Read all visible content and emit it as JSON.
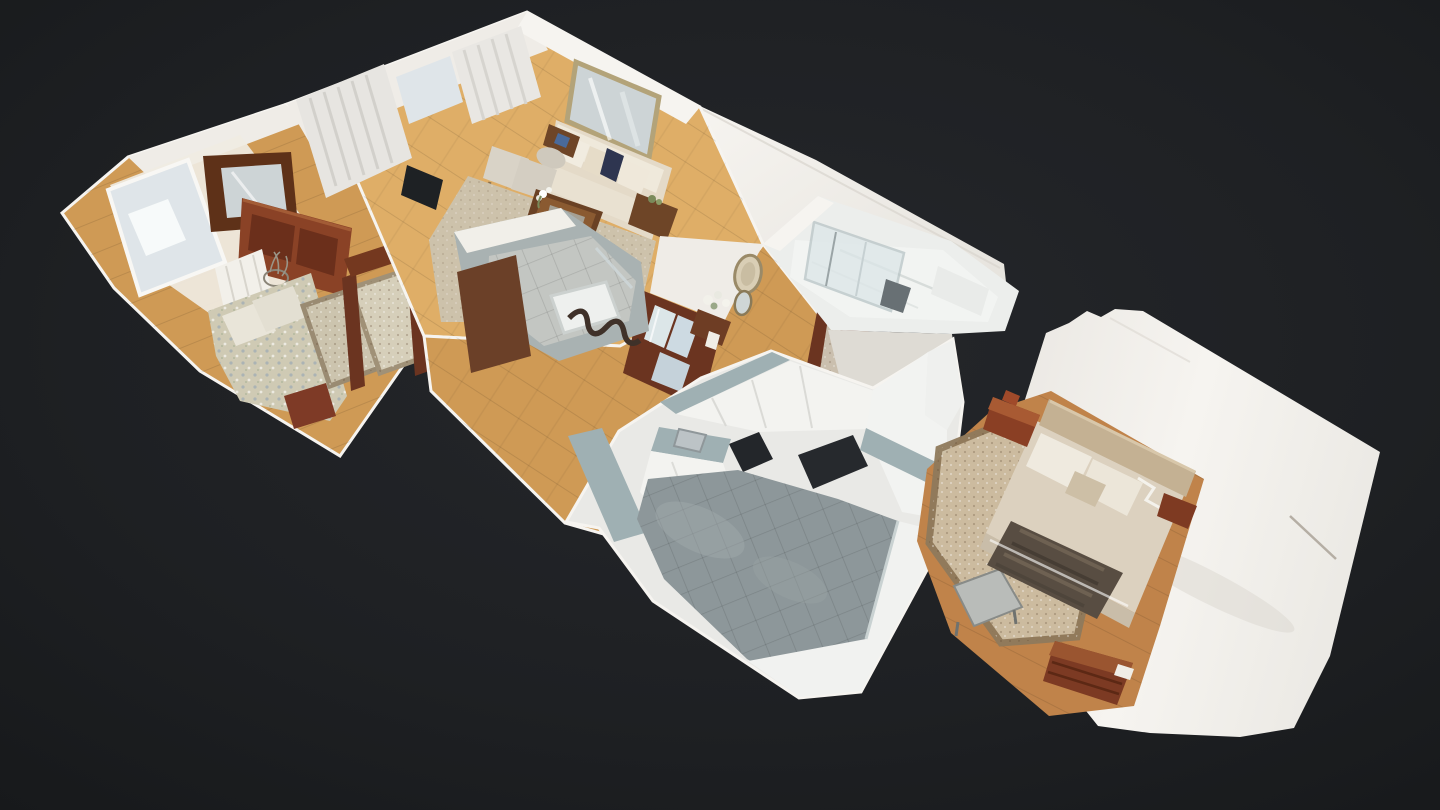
{
  "viewer": {
    "view_mode": "dollhouse-3d",
    "rooms": [
      {
        "id": "small-bedroom"
      },
      {
        "id": "living-room"
      },
      {
        "id": "hallway-entry"
      },
      {
        "id": "interior-bathroom"
      },
      {
        "id": "bathroom"
      },
      {
        "id": "kitchen"
      },
      {
        "id": "master-bedroom"
      }
    ]
  },
  "colors": {
    "background": "#191b1d",
    "backgroundGlow": "#26282c",
    "wall": "#efece7",
    "wallBright": "#f6f4f0",
    "wallShade": "#dedbd4",
    "wallCut": "#9fb0b3",
    "woodFloor": "#cf9a55",
    "woodFloorDeep": "#c0834a",
    "woodFloorLight": "#dfae67",
    "kitchenTile": "#8d979a",
    "cabinetWhite": "#f3f3f0",
    "counterTeal": "#9fb0b3",
    "applianceDark": "#23262a",
    "steel": "#aeb6ba",
    "furnitureWood": "#7c3a23",
    "furnitureWoodLight": "#9a5530",
    "doorFrame": "#6b3420",
    "rug": "#cdc2ab",
    "rugShade": "#8f7a5c",
    "sofa": "#e4dac8",
    "cushion": "#efe9db",
    "floralBed": "#cfcab4",
    "headboard": "#c4b193",
    "duvet": "#dcd1bf",
    "pillow": "#efeadf",
    "throw": "#584d42",
    "glass": "#dce6e8",
    "mirror": "#cdd4d6",
    "mirrorFrame": "#b3a379",
    "curtain": "#e7e5e1",
    "windowLight": "#dfe5e9",
    "bathTile": "#f2f4f2",
    "navy": "#2e3550",
    "accentRed": "#a33c2e",
    "plantGreen": "#7a8a5a"
  }
}
